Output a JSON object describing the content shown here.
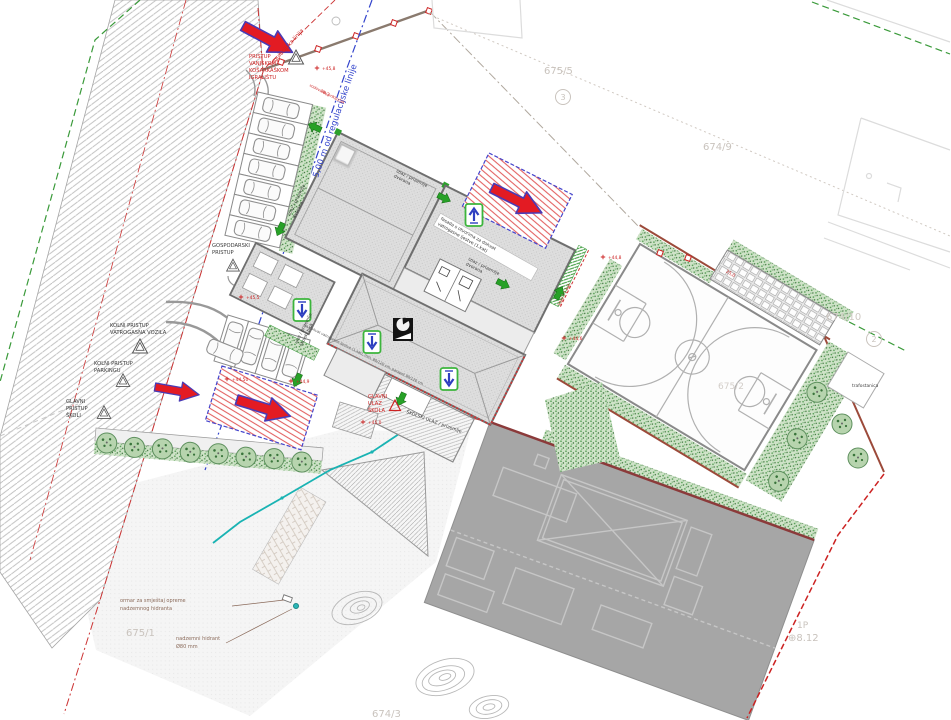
{
  "labels": {
    "offset_line": "5,00 m od regulacijske linije",
    "regulation_line": "regulacijska linija",
    "access_note": {
      "l1": "PRISTUP",
      "l2": "VANJSKOM",
      "l3": "KOŠARKAŠKOM",
      "l4": "IGRALIŠTU"
    },
    "gospodarski": {
      "l1": "GOSPODARSKI",
      "l2": "PRISTUP"
    },
    "kolni_vatrogasni": {
      "l1": "KOLNI PRISTUP",
      "l2": "VATROGASNA VOZILA"
    },
    "kolni_parking": {
      "l1": "KOLNI PRISTUP",
      "l2": "PARKINGU"
    },
    "glavni_pristup": {
      "l1": "GLAVNI",
      "l2": "PRISTUP",
      "l3": "ŠKOLI"
    },
    "glavni_ulaz": {
      "l1": "GLAVNI",
      "l2": "ULAZ",
      "l3": "ŠKOLA"
    },
    "skolski_ulaz": "ŠKOLSKI ULAZ / prizemlje",
    "exit_hall": {
      "l1": "izlaz / prizemlje",
      "l2": "dvorana"
    },
    "entry_school_block": {
      "l1": "ulaz / prizemlje",
      "l2": "školski blok"
    },
    "exit_floor": "izlaz / 1.kat",
    "facade_note": {
      "l1": "fasada s otvorima za dohvat",
      "l2": "vatrogasne ljestve (1.kat)"
    },
    "facade_note2": "za dohvat vatrogasne ljestve (1.kat), min. 80/120 cm, parapet 90/120 cm",
    "water_note": "vodovodni priključak",
    "hydrant_cabinet": {
      "l1": "ormar za smještaj opreme",
      "l2": "nadzemnog hidranta"
    },
    "hydrant": {
      "l1": "nadzemni hidrant",
      "l2": "Ø80 mm"
    },
    "trafostanica": "trafostanica"
  },
  "parcels": {
    "p675_5": "675/5",
    "p674_9": "674/9",
    "p674_10": "674/10",
    "p675_1": "675/1",
    "p674_3": "674/3",
    "p675_2": "675/2",
    "p1p": "1P",
    "benchmark": "⊕8.12",
    "c2": "2",
    "c3": "3"
  },
  "elevations": {
    "e1": "+45,5",
    "e2": "+44,50",
    "e3": "+44,9",
    "e4": "+44,8",
    "e5": "+44,6",
    "e6": "+45,0",
    "e7": "+45,8"
  },
  "dimensions": {
    "d1": "76,2",
    "d2": "25,0"
  },
  "colors": {
    "boundary_red": "#cc2222",
    "fire_red": "#e31b23",
    "arrow_outline": "#4a3bb5",
    "green": "#2e7d32",
    "teal": "#19b3b3",
    "blue_line": "#3344cc"
  }
}
